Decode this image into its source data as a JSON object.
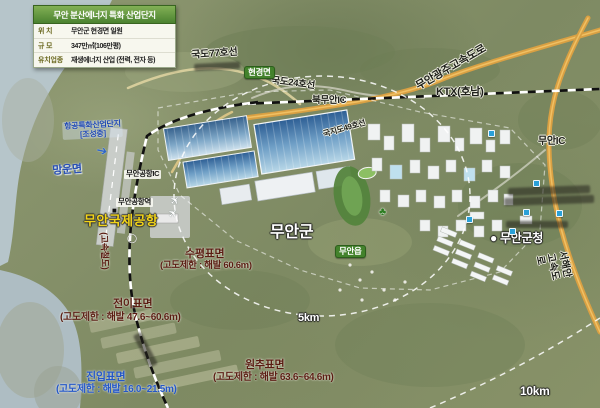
{
  "info_box": {
    "title": "무안 분산에너지 특화 산업단지",
    "rows": [
      {
        "label": "위  치",
        "value": "무안군 현경면 일원"
      },
      {
        "label": "규  모",
        "value": "347만㎡(106만평)"
      },
      {
        "label": "유치업종",
        "value": "재생에너지 산업 (전력, 전자 등)"
      }
    ]
  },
  "map_labels": [
    {
      "name": "road-label-77",
      "text": "국도77호선",
      "x": 191,
      "y": 50,
      "cls": "halo-dark",
      "fs": 10,
      "rot": -4
    },
    {
      "name": "road-label-24",
      "text": "국도24호선",
      "x": 272,
      "y": 76,
      "cls": "halo-dark",
      "fs": 9.5,
      "rot": 7
    },
    {
      "name": "badge-hyeongyeong",
      "text": "현경면",
      "x": 244,
      "y": 66,
      "cls": "badge-green",
      "fs": 8.5,
      "rot": 0
    },
    {
      "name": "ic-bukmuan",
      "text": "북무안IC",
      "x": 312,
      "y": 96,
      "cls": "halo-dark",
      "fs": 9.5,
      "rot": 0
    },
    {
      "name": "expwy-muan-gwangju",
      "text": "무안광주고속도로",
      "x": 414,
      "y": 82,
      "cls": "halo-dark",
      "fs": 11,
      "rot": -30
    },
    {
      "name": "ktx-line-label",
      "text": "KTX(호남)",
      "x": 436,
      "y": 86,
      "cls": "halo-dark",
      "fs": 11,
      "rot": 0
    },
    {
      "name": "ic-muan",
      "text": "무안IC",
      "x": 538,
      "y": 136,
      "cls": "halo-dark",
      "fs": 10,
      "rot": 0
    },
    {
      "name": "expwy-seohaean",
      "text": "서해안고속도로",
      "x": 567,
      "y": 250,
      "cls": "halo-dark",
      "fs": 10,
      "rot": 78
    },
    {
      "name": "road-label-49",
      "text": "국지도49호선",
      "x": 322,
      "y": 130,
      "cls": "halo-dark",
      "fs": 8,
      "rot": -16
    },
    {
      "name": "town-mangun",
      "text": "망운면",
      "x": 52,
      "y": 165,
      "cls": "blue-town",
      "fs": 11,
      "rot": -4
    },
    {
      "name": "aviation-complex-label",
      "text": "항공특화산업단지\n[조성중]",
      "x": 62,
      "y": 122,
      "cls": "blue-small",
      "fs": 8,
      "rot": -3
    },
    {
      "name": "arrow-to-runway-icon",
      "text": "➔",
      "x": 98,
      "y": 143,
      "cls": "blue-arrow",
      "fs": 13,
      "rot": 12
    },
    {
      "name": "ic-muan-airport",
      "text": "무안공항IC",
      "x": 124,
      "y": 170,
      "cls": "box-light",
      "fs": 7.5,
      "rot": 0
    },
    {
      "name": "station-muan-airport",
      "text": "무안공항역",
      "x": 116,
      "y": 198,
      "cls": "box-light",
      "fs": 7.5,
      "rot": 0
    },
    {
      "name": "station-marker-icon",
      "text": "■",
      "x": 112,
      "y": 206,
      "cls": "dark-marker",
      "fs": 8,
      "rot": 0
    },
    {
      "name": "airport-name",
      "text": "무안국제공항",
      "x": 84,
      "y": 214,
      "cls": "yellow-big",
      "fs": 13,
      "rot": 0
    },
    {
      "name": "heliport-mark-icon",
      "text": "◯",
      "x": 127,
      "y": 233,
      "cls": "white-mark",
      "fs": 9,
      "rot": 0
    },
    {
      "name": "airplane-icon",
      "text": "✈",
      "x": 168,
      "y": 200,
      "cls": "plane",
      "fs": 11,
      "rot": -45
    },
    {
      "name": "airplane-icon",
      "text": "✈",
      "x": 166,
      "y": 213,
      "cls": "plane",
      "fs": 11,
      "rot": -45
    },
    {
      "name": "hsr-vertical-label",
      "text": "(고속철도)",
      "x": 109,
      "y": 232,
      "cls": "maroon",
      "fs": 9,
      "rot": 88
    },
    {
      "name": "district-muan",
      "text": "무안군",
      "x": 270,
      "y": 224,
      "cls": "white-big",
      "fs": 16,
      "rot": 0
    },
    {
      "name": "badge-muaneup",
      "text": "무안읍",
      "x": 335,
      "y": 245,
      "cls": "badge-green",
      "fs": 8.5,
      "rot": 0
    },
    {
      "name": "tree-icon",
      "text": "♣",
      "x": 379,
      "y": 206,
      "cls": "tree",
      "fs": 11,
      "rot": 0
    },
    {
      "name": "gov-muan",
      "text": "● 무안군청",
      "x": 490,
      "y": 232,
      "cls": "white-big",
      "fs": 12,
      "rot": 0
    },
    {
      "name": "surface-horizontal-title",
      "text": "수평표면",
      "x": 185,
      "y": 248,
      "cls": "maroon",
      "fs": 11,
      "rot": 0
    },
    {
      "name": "surface-horizontal-sub",
      "text": "(고도제한 : 해발 60.6m)",
      "x": 160,
      "y": 261,
      "cls": "maroon",
      "fs": 9.5,
      "rot": 0
    },
    {
      "name": "surface-transition-title",
      "text": "전이표면",
      "x": 113,
      "y": 298,
      "cls": "maroon",
      "fs": 11,
      "rot": 0
    },
    {
      "name": "surface-transition-sub",
      "text": "(고도제한 : 해발 47.6~60.6m)",
      "x": 60,
      "y": 312,
      "cls": "maroon",
      "fs": 10,
      "rot": 0
    },
    {
      "name": "surface-approach-title",
      "text": "진입표면",
      "x": 86,
      "y": 371,
      "cls": "blue-strong",
      "fs": 11,
      "rot": 0
    },
    {
      "name": "surface-approach-sub",
      "text": "(고도제한 : 해발 16.0~21.5m)",
      "x": 56,
      "y": 384,
      "cls": "blue-strong",
      "fs": 10,
      "rot": 0
    },
    {
      "name": "surface-conical-title",
      "text": "원추표면",
      "x": 245,
      "y": 359,
      "cls": "maroon",
      "fs": 11,
      "rot": 0
    },
    {
      "name": "surface-conical-sub",
      "text": "(고도제한 : 해발 63.6~64.6m)",
      "x": 213,
      "y": 372,
      "cls": "maroon",
      "fs": 10,
      "rot": 0
    },
    {
      "name": "range-5km",
      "text": "5km",
      "x": 298,
      "y": 312,
      "cls": "white-big",
      "fs": 11,
      "rot": 0
    },
    {
      "name": "range-10km",
      "text": "10km",
      "x": 520,
      "y": 385,
      "cls": "white-big",
      "fs": 12,
      "rot": 0
    }
  ],
  "smudges": [
    {
      "x": 194,
      "y": 64,
      "w": 46,
      "h": 7,
      "rot": -3
    },
    {
      "x": 508,
      "y": 188,
      "w": 82,
      "h": 8,
      "rot": -2
    },
    {
      "x": 504,
      "y": 198,
      "w": 90,
      "h": 8,
      "rot": -2
    },
    {
      "x": 506,
      "y": 221,
      "w": 62,
      "h": 7,
      "rot": 0
    },
    {
      "x": 133,
      "y": 336,
      "w": 9,
      "h": 36,
      "rot": -28
    }
  ],
  "poi_dots": [
    {
      "x": 533,
      "y": 180
    },
    {
      "x": 523,
      "y": 209
    },
    {
      "x": 556,
      "y": 210
    },
    {
      "x": 466,
      "y": 216
    },
    {
      "x": 509,
      "y": 228
    },
    {
      "x": 488,
      "y": 130
    }
  ],
  "colors": {
    "road_orange": "#d9a043",
    "sea": "#b6c5ca",
    "badge_green": "#43822c",
    "surface_maroon": "#5a1d12",
    "approach_blue": "#2457c5",
    "airport_yellow": "#f2d418"
  }
}
